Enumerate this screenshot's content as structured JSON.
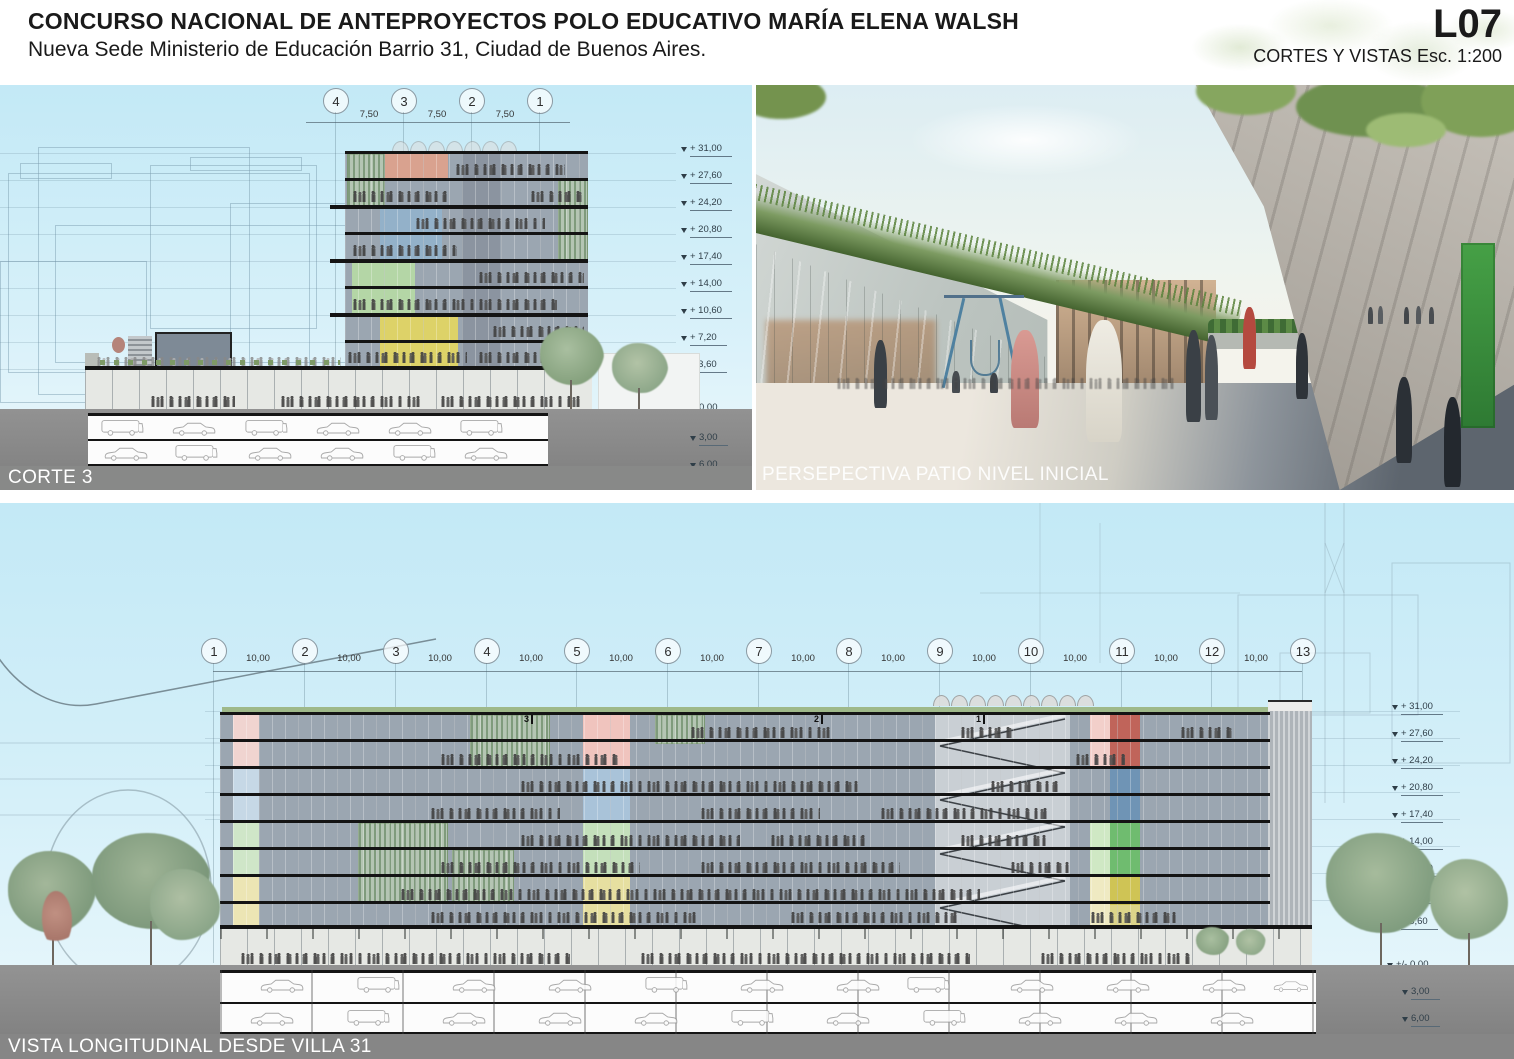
{
  "header": {
    "title": "CONCURSO NACIONAL DE ANTEPROYECTOS POLO EDUCATIVO MARÍA ELENA WALSH",
    "subtitle": "Nueva Sede Ministerio de Educación Barrio 31, Ciudad de Buenos Aires.",
    "sheet_code": "L07",
    "sheet_info": "CORTES Y VISTAS Esc. 1:200"
  },
  "levels": {
    "above": [
      "+ 31,00",
      "+ 27,60",
      "+ 24,20",
      "+ 20,80",
      "+ 17,40",
      "+ 14,00",
      "+ 10,60",
      "+ 7,20",
      "+ 3,60"
    ],
    "zero": "+/- 0,00",
    "below": [
      "3,00",
      "6,00"
    ]
  },
  "corte3": {
    "label": "CORTE 3",
    "grid": [
      "4",
      "3",
      "2",
      "1"
    ],
    "dims": [
      "7,50",
      "7,50",
      "7,50"
    ]
  },
  "perspective": {
    "label": "PERSEPECTIVA PATIO NIVEL INICIAL"
  },
  "vista": {
    "label": "VISTA LONGITUDINAL DESDE VILLA 31",
    "grid": [
      "1",
      "2",
      "3",
      "4",
      "5",
      "6",
      "7",
      "8",
      "9",
      "10",
      "11",
      "12",
      "13"
    ],
    "dims": [
      "10,00",
      "10,00",
      "10,00",
      "10,00",
      "10,00",
      "10,00",
      "10,00",
      "10,00",
      "10,00",
      "10,00",
      "10,00",
      "10,00"
    ],
    "section_markers": [
      "3",
      "2",
      "1"
    ]
  }
}
